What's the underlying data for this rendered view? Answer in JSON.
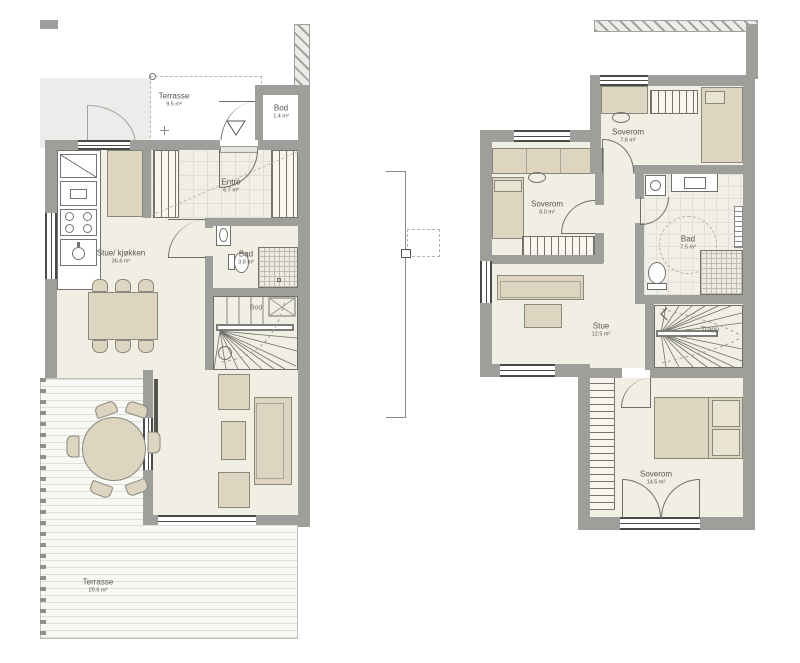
{
  "ground_floor": {
    "terrasse_top": {
      "name": "Terrasse",
      "area": "9.5 m²"
    },
    "bod_top": {
      "name": "Bod",
      "area": "1.4 m²"
    },
    "entre": {
      "name": "Entré",
      "area": "6.7 m²"
    },
    "stue_kjokken": {
      "name": "Stue/ kjøkken",
      "area": "36.6 m²"
    },
    "bad": {
      "name": "Bad",
      "area": "3.8 m²"
    },
    "bod_under_stairs": {
      "name": "Bod"
    },
    "terrasse_main": {
      "name": "Terrasse",
      "area": "29.6 m²"
    }
  },
  "upper_floor": {
    "soverom_left": {
      "name": "Soverom",
      "area": "8.0 m²"
    },
    "soverom_top": {
      "name": "Soverom",
      "area": "7.6 m²"
    },
    "bad": {
      "name": "Bad",
      "area": "7.5 m²"
    },
    "stue": {
      "name": "Stue",
      "area": "12.5 m²"
    },
    "trapp": {
      "name": "Trapp"
    },
    "soverom_main": {
      "name": "Soverom",
      "area": "14.5 m²"
    }
  },
  "colors": {
    "wall": "#9e9e9a",
    "floor": "#f1eee3",
    "furniture": "#ddd5bf",
    "furniture_border": "#8a877c",
    "neighbor": "#ececea",
    "hatch": "#a3a39e",
    "text": "#55544f",
    "dash": "#b5b5ae"
  }
}
